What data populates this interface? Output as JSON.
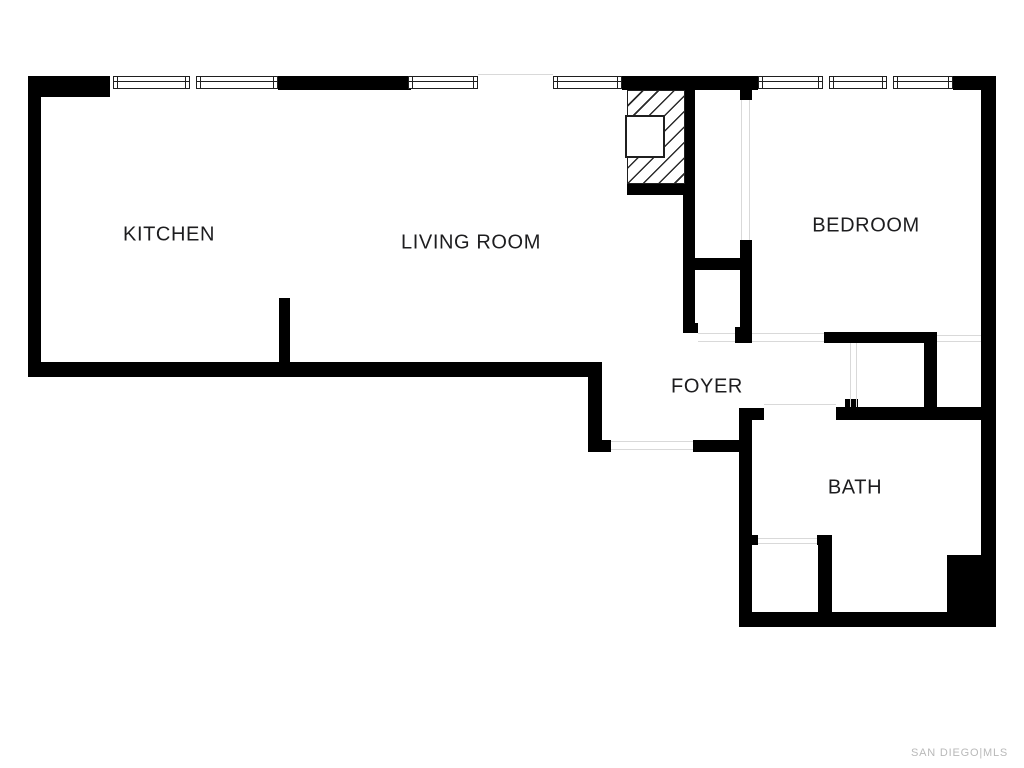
{
  "page": {
    "type": "real-estate-floor-plan",
    "colors": {
      "background": "#ffffff",
      "wall": "#000000",
      "frame": "#1f1f1f",
      "opening_line": "#d9d9d9",
      "label": "#1d1d1f",
      "watermark": "#b9b9b9"
    }
  },
  "watermark": {
    "text": "SAN DIEGO|MLS"
  },
  "floorplan": {
    "rooms": [
      {
        "id": "kitchen",
        "label": "KITCHEN",
        "cx": 169,
        "cy": 235
      },
      {
        "id": "living-room",
        "label": "LIVING ROOM",
        "cx": 471,
        "cy": 243
      },
      {
        "id": "bedroom",
        "label": "BEDROOM",
        "cx": 866,
        "cy": 226
      },
      {
        "id": "foyer",
        "label": "FOYER",
        "cx": 707,
        "cy": 387
      },
      {
        "id": "bath",
        "label": "BATH",
        "cx": 855,
        "cy": 488
      }
    ],
    "walls": [
      [
        28,
        76,
        82,
        21
      ],
      [
        28,
        76,
        13,
        301
      ],
      [
        278,
        76,
        133,
        14
      ],
      [
        622,
        76,
        136,
        14
      ],
      [
        953,
        76,
        43,
        14
      ],
      [
        981,
        76,
        15,
        549
      ],
      [
        28,
        362,
        574,
        15
      ],
      [
        279,
        298,
        11,
        65
      ],
      [
        588,
        377,
        14,
        75
      ],
      [
        588,
        440,
        23,
        12
      ],
      [
        693,
        440,
        59,
        12
      ],
      [
        683,
        90,
        12,
        243
      ],
      [
        683,
        323,
        15,
        10
      ],
      [
        690,
        258,
        62,
        12
      ],
      [
        740,
        90,
        12,
        10
      ],
      [
        740,
        240,
        12,
        103
      ],
      [
        735,
        327,
        17,
        16
      ],
      [
        824,
        332,
        113,
        11
      ],
      [
        924,
        343,
        13,
        72
      ],
      [
        836,
        407,
        160,
        13
      ],
      [
        845,
        399,
        13,
        11
      ],
      [
        739,
        408,
        13,
        219
      ],
      [
        739,
        408,
        25,
        12
      ],
      [
        739,
        612,
        257,
        15
      ],
      [
        750,
        535,
        8,
        10
      ],
      [
        817,
        535,
        15,
        10
      ],
      [
        818,
        545,
        14,
        68
      ],
      [
        947,
        555,
        49,
        70
      ],
      [
        627,
        184,
        58,
        11
      ]
    ],
    "windows": [
      {
        "y": 76,
        "h": 13,
        "panes": [
          [
            113,
            77
          ],
          [
            196,
            82
          ]
        ]
      },
      {
        "y": 76,
        "h": 13,
        "panes": [
          [
            408,
            70
          ]
        ]
      },
      {
        "y": 76,
        "h": 13,
        "panes": [
          [
            553,
            69
          ]
        ]
      },
      {
        "y": 76,
        "h": 13,
        "panes": [
          [
            758,
            65
          ],
          [
            829,
            58
          ],
          [
            893,
            60
          ]
        ]
      }
    ],
    "openings": [
      [
        478,
        74,
        75,
        1
      ],
      [
        741,
        100,
        1,
        140
      ],
      [
        749,
        100,
        1,
        140
      ],
      [
        698,
        333,
        37,
        1
      ],
      [
        698,
        341,
        37,
        1
      ],
      [
        752,
        333,
        72,
        1
      ],
      [
        752,
        341,
        72,
        1
      ],
      [
        937,
        335,
        44,
        1
      ],
      [
        937,
        341,
        44,
        1
      ],
      [
        850,
        343,
        1,
        64
      ],
      [
        856,
        343,
        1,
        64
      ],
      [
        764,
        404,
        72,
        1
      ],
      [
        611,
        441,
        82,
        1
      ],
      [
        611,
        449,
        82,
        1
      ],
      [
        758,
        538,
        59,
        1
      ],
      [
        758,
        543,
        59,
        1
      ]
    ],
    "fireplace": {
      "hatch": [
        627,
        90,
        58,
        94
      ],
      "inner": [
        625,
        115,
        40,
        43
      ]
    }
  }
}
